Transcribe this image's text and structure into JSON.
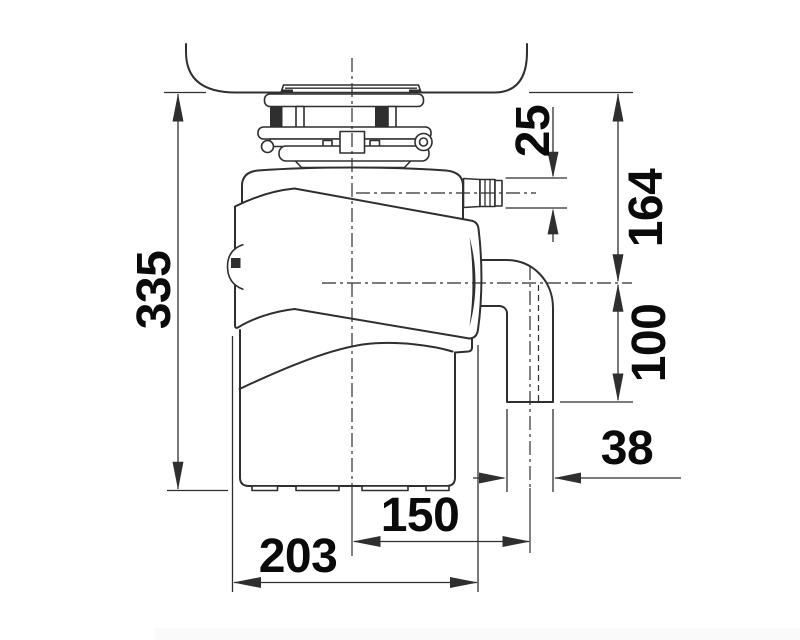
{
  "drawing": {
    "subject": "food-waste-disposer-dimension-drawing",
    "background": "#ffffff",
    "line_color": "#2f2f2f",
    "label_color": "#0a0a0a",
    "footer_bar_color": "#fafafa",
    "dimension_labels": {
      "overall_height": "335",
      "inlet_hose_diameter": "25",
      "sink_to_outlet_axis": "164",
      "outlet_axis_to_pipe_end": "100",
      "outlet_pipe_diameter": "38",
      "axis_to_outlet_offset": "150",
      "body_width": "203"
    }
  }
}
